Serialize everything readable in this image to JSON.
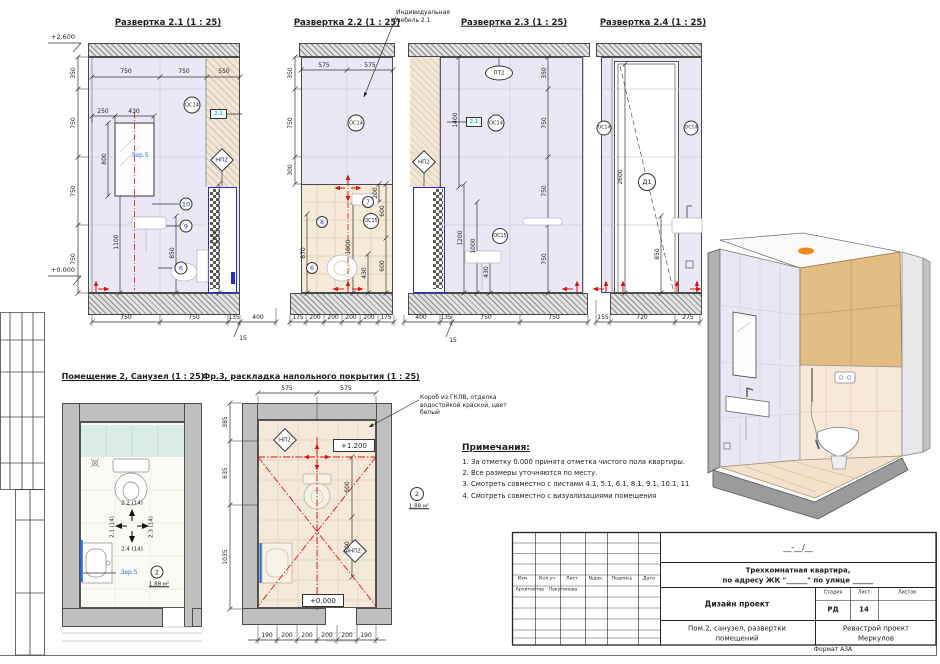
{
  "sheet": {
    "format_note": "Формат А3А"
  },
  "elev1": {
    "title": "Развертка 2.1 (1 : 25)",
    "lvl_top": "+2.600",
    "lvl_bot": "+0.000",
    "top": [
      "750",
      "750",
      "550"
    ],
    "left": [
      "350",
      "750",
      "750",
      "750"
    ],
    "w250": "250",
    "w430": "430",
    "h800": "800",
    "h1100": "1100",
    "h850": "850",
    "h1200": "1200",
    "bottom": [
      "750",
      "750",
      "135",
      "400"
    ],
    "flag": "15",
    "os14": "ОС14",
    "frag": "2.1",
    "np2": "НП2",
    "mirror": "Зер.5",
    "c10": "10",
    "c9": "9",
    "c6": "6"
  },
  "elev2": {
    "title": "Развертка 2.2 (1 : 25)",
    "ann": "Индивидуальная мебель 2.1",
    "top": [
      "575",
      "575"
    ],
    "left": [
      "350",
      "750",
      "300"
    ],
    "h870": "870",
    "h200": "200",
    "h600a": "600",
    "h1000": "1000",
    "h430": "430",
    "h600b": "600",
    "bottom": [
      "175",
      "200",
      "200",
      "200",
      "200",
      "175"
    ],
    "os14": "ОС14",
    "os15": "ОС15",
    "c7": "7",
    "c8": "8",
    "c6": "6"
  },
  "elev3": {
    "title": "Развертка 2.3 (1 : 25)",
    "pt2": "ПТ2",
    "frag": "2.1",
    "os14": "ОС14",
    "os15": "ОС15",
    "np2": "НП2",
    "right": [
      "350",
      "750",
      "750",
      "750"
    ],
    "h1400": "1400",
    "h1200": "1200",
    "h1000": "1000",
    "h430": "430",
    "bottom": [
      "400",
      "135",
      "750",
      "750"
    ],
    "flag": "15"
  },
  "elev4": {
    "title": "Развертка 2.4 (1 : 25)",
    "os14l": "ОС14",
    "os14r": "ОС14",
    "d1": "Д1",
    "h2600": "2600",
    "h850": "850",
    "bottom": [
      "155",
      "720",
      "275"
    ]
  },
  "plan": {
    "title": "Помещение 2, Санузел (1 : 25)",
    "dir_top": "2.2 (14)",
    "dir_left": "2.1 (14)",
    "dir_right": "2.3 (14)",
    "dir_bottom": "2.4 (14)",
    "mirror": "Зер.5",
    "room_no": "2",
    "area": "1.88 м²"
  },
  "floor": {
    "title": "Фр.3, раскладка напольного покрытия (1 : 25)",
    "ann": "Короб из ГКЛВ, отделка водостойкой краской, цвет белый",
    "top": [
      "575",
      "575"
    ],
    "left": [
      "385",
      "635",
      "1035"
    ],
    "inner": [
      "600",
      "600"
    ],
    "lvl_hi": "+1.200",
    "lvl_lo": "+0.000",
    "np2a": "НП2",
    "np2b": "НП2",
    "bottom": [
      "190",
      "200",
      "200",
      "200",
      "200",
      "190"
    ],
    "room_no": "2",
    "area": "1.88 м²"
  },
  "notes": {
    "title": "Примечания:",
    "items": [
      "За отметку 0.000 принята отметка чистого пола квартиры.",
      "Все размеры уточняются по месту.",
      "Смотреть совместно с листами 4.1, 5.1, 6.1, 8.1, 9.1, 10.1, 11",
      "Смотреть совместно с визуализациями помещения"
    ]
  },
  "titleblock": {
    "code": "__-__/__",
    "project_line1": "Трехкомнатная квартира,",
    "project_line2": "по адресу ЖК \"______\" по улице ______",
    "doc_type": "Дизайн проект",
    "stage_label": "Стадия",
    "sheet_label": "Лист",
    "sheets_label": "Листов",
    "stage": "РД",
    "sheet_no": "14",
    "subject_line1": "Пом.2, санузел, развертки",
    "subject_line2": "помещений",
    "company_line1": "Ревастрой проект",
    "company_line2": "Меркулов",
    "cols": [
      "Изм.",
      "Кол.уч",
      "Лист",
      "№док.",
      "Подпись",
      "Дата"
    ],
    "role": "Архитектор",
    "name": "Лакутинова"
  }
}
